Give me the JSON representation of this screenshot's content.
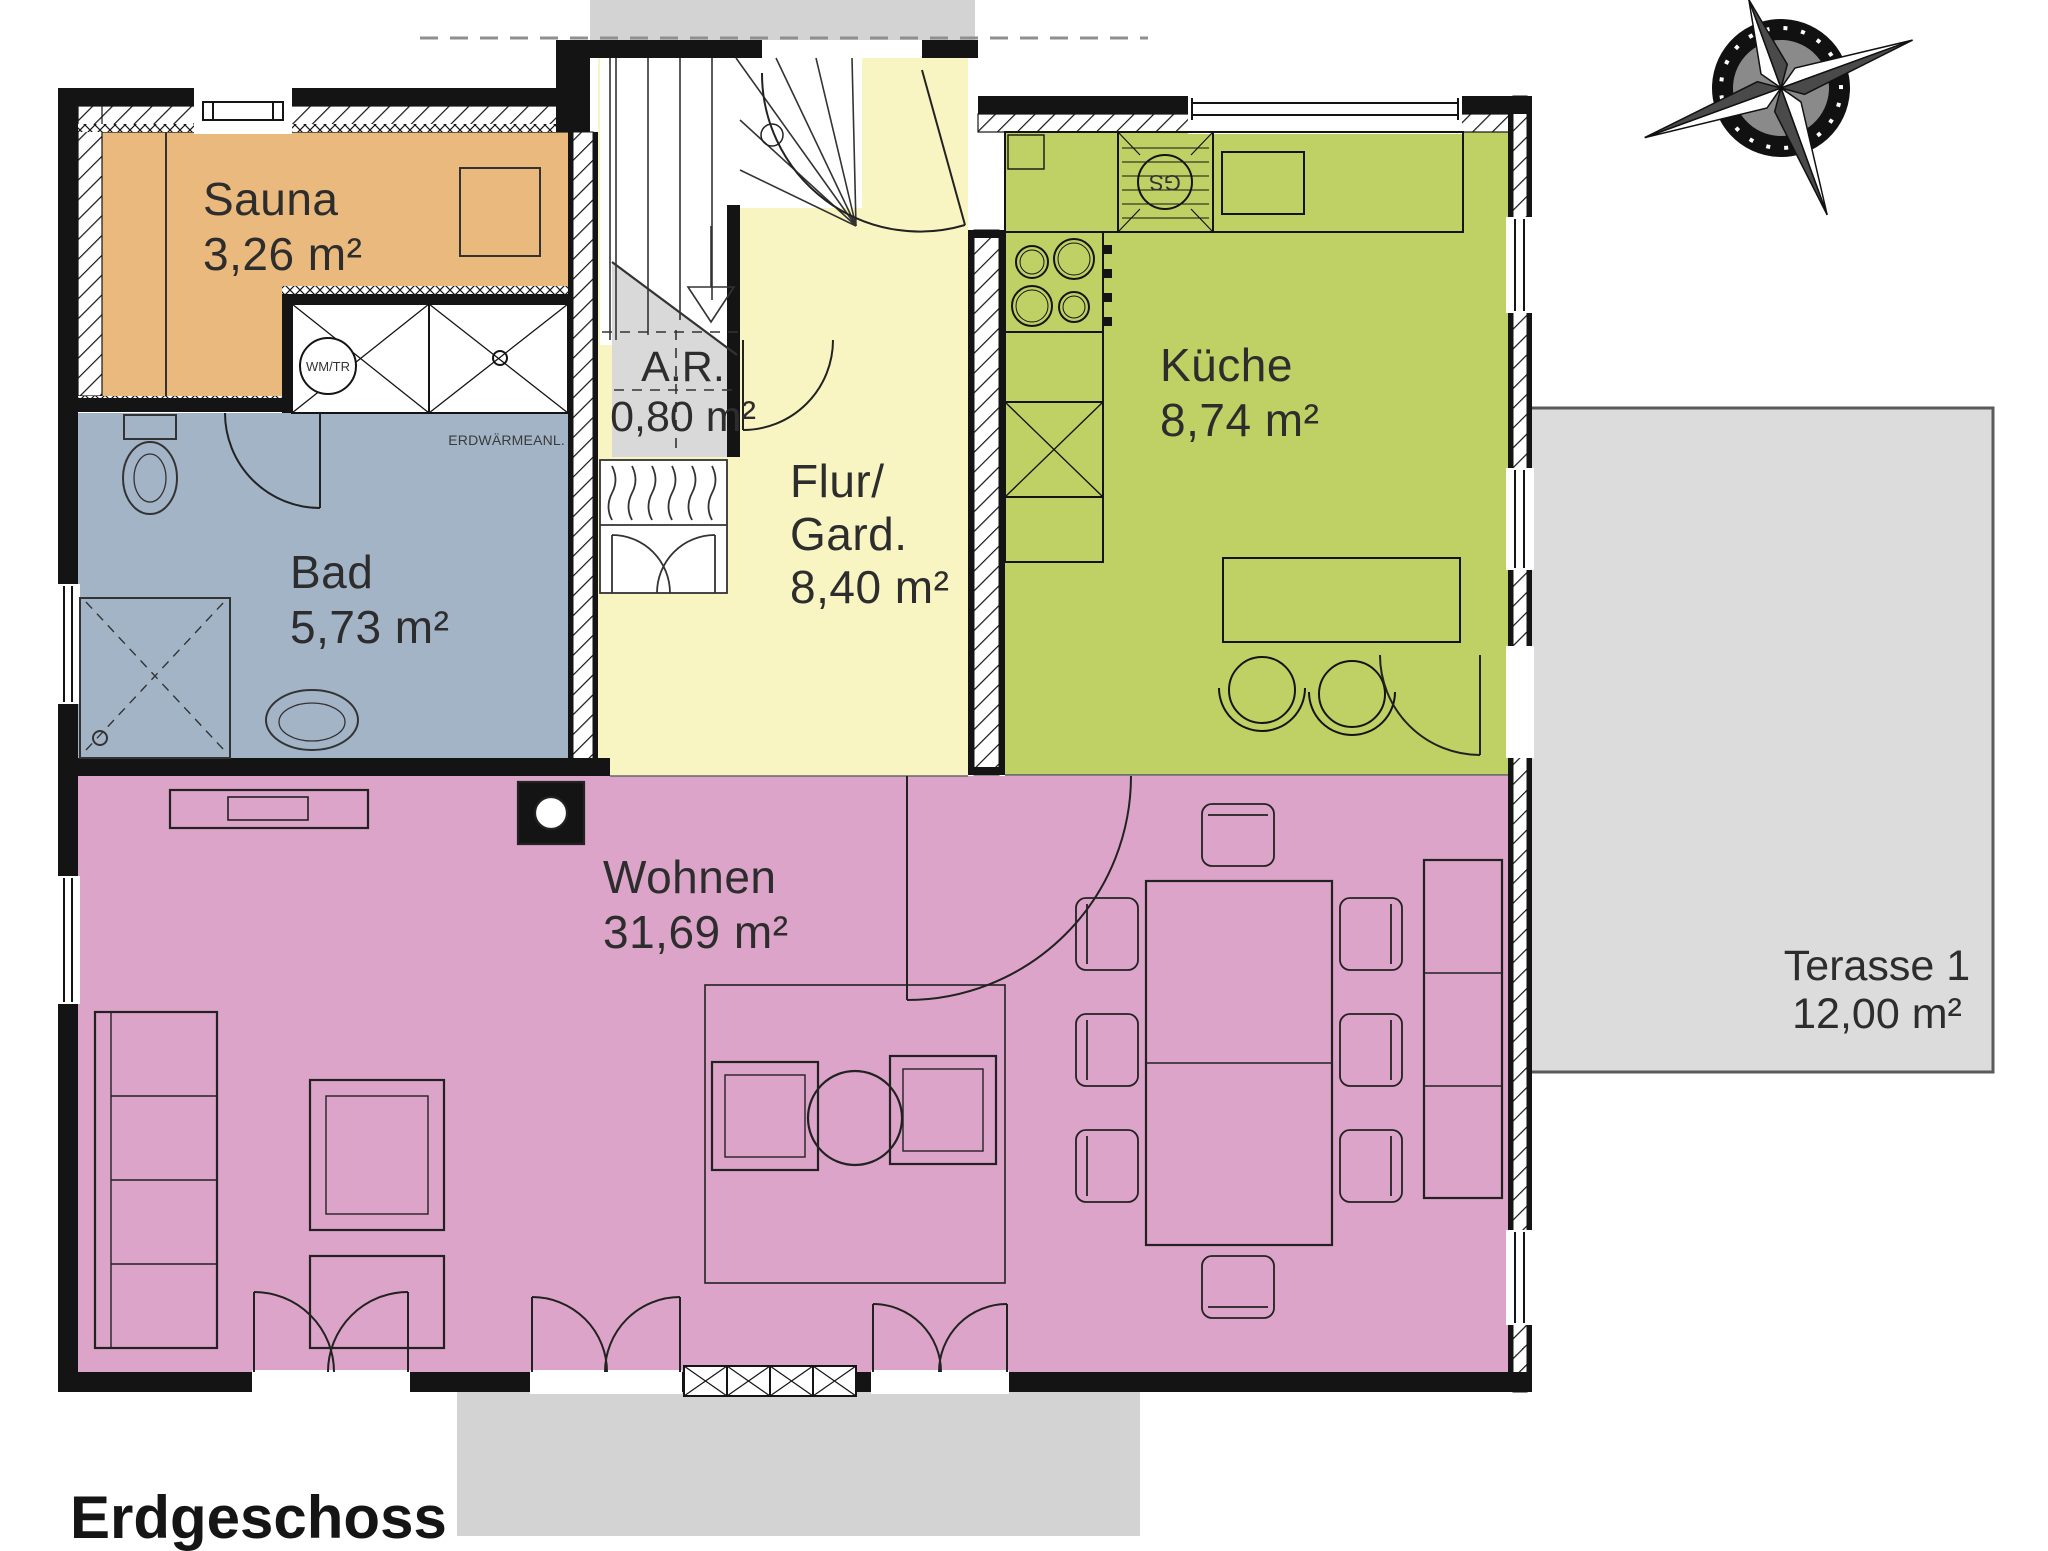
{
  "floor_title": "Erdgeschoss",
  "rooms": {
    "sauna": {
      "name": "Sauna",
      "area": "3,26 m²",
      "color": "#E9B97E"
    },
    "bad": {
      "name": "Bad",
      "area": "5,73 m²",
      "color": "#A3B4C7"
    },
    "abstellraum": {
      "name": "A.R.",
      "area": "0,80 m²",
      "color": "#D9D9D9"
    },
    "flur": {
      "name_line1": "Flur/",
      "name_line2": "Gard.",
      "area": "8,40 m²",
      "color": "#F8F5C2"
    },
    "kueche": {
      "name": "Küche",
      "area": "8,74 m²",
      "color": "#BFD164"
    },
    "wohnen": {
      "name": "Wohnen",
      "area": "31,69 m²",
      "color": "#DCA4C8"
    },
    "terrasse": {
      "name": "Terasse 1",
      "area": "12,00 m²",
      "color": "#DCDCDC"
    }
  },
  "annotations": {
    "geothermal_unit": "ERDWÄRMEANL.",
    "washer_dryer": "WM/TR",
    "dishwasher": "GS"
  },
  "palette": {
    "wall": "#141414",
    "exterior_gray": "#D3D3D3",
    "text": "#2d2d2d"
  }
}
